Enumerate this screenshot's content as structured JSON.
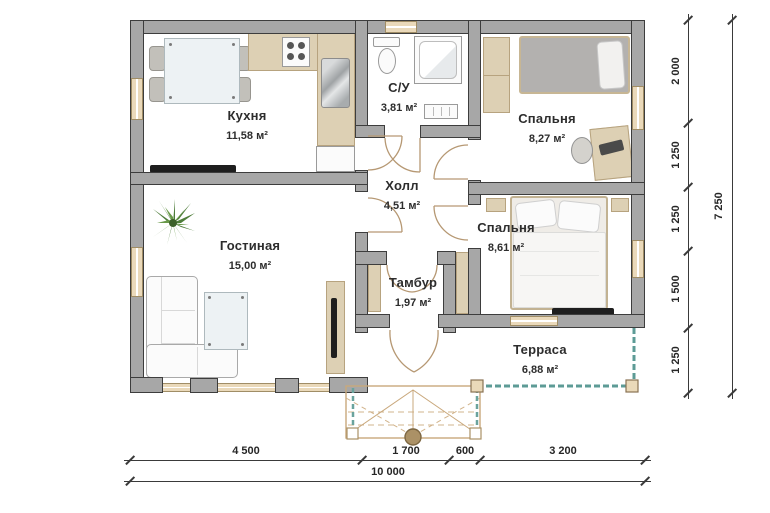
{
  "plan": {
    "rooms": [
      {
        "id": "kitchen",
        "name": "Кухня",
        "area": "11,58 м²"
      },
      {
        "id": "bathroom",
        "name": "С/У",
        "area": "3,81 м²"
      },
      {
        "id": "bedroom-1",
        "name": "Спальня",
        "area": "8,27 м²"
      },
      {
        "id": "hall",
        "name": "Холл",
        "area": "4,51 м²"
      },
      {
        "id": "living-room",
        "name": "Гостиная",
        "area": "15,00 м²"
      },
      {
        "id": "bedroom-2",
        "name": "Спальня",
        "area": "8,61 м²"
      },
      {
        "id": "vestibule",
        "name": "Тамбур",
        "area": "1,97 м²"
      },
      {
        "id": "terrace",
        "name": "Терраса",
        "area": "6,88 м²"
      }
    ],
    "dimensions": {
      "right": [
        "2 000",
        "1 250",
        "1 250",
        "1 500",
        "1 250"
      ],
      "right_total": "7 250",
      "bottom": [
        "4 500",
        "1 700",
        "600",
        "3 200"
      ],
      "bottom_total": "10 000"
    },
    "colors": {
      "wall_fill": "#a7a7a7",
      "wall_outline": "#3d3d3d",
      "window_fill": "#ead9ba",
      "wood_furniture": "#ddd0b4",
      "terrace_line": "#5d9b96",
      "dimension_line": "#3a3a3a"
    }
  }
}
